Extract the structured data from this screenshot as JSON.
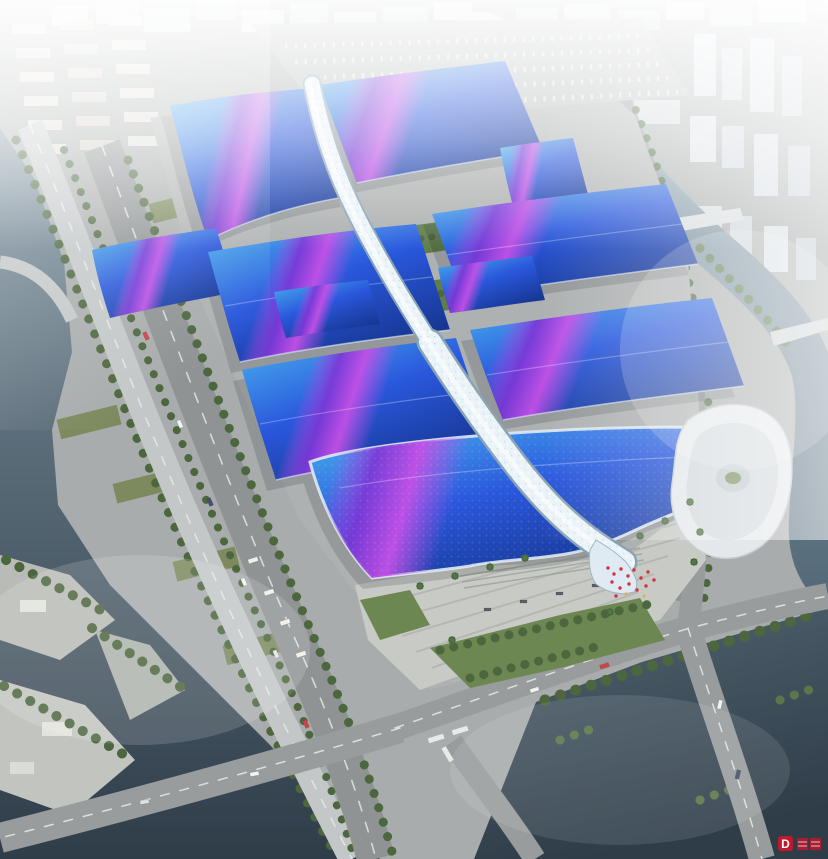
{
  "scene": {
    "type": "aerial-architectural-rendering",
    "subject": "riverside-exhibition-convention-center-complex",
    "watermark": {
      "logo_letter": "D",
      "adjacent_glyphs_illegible": true
    },
    "colors": {
      "roof_cyan": "#49b4ee",
      "roof_blue": "#2a58dd",
      "roof_deep_blue": "#16358f",
      "stripe_magenta": "#c44fe6",
      "stripe_violet": "#7d36d6",
      "spine_white": "#eaf3f8",
      "spine_shade": "#8ba4b5",
      "water_light": "#7b909d",
      "water_dark": "#2f3d49",
      "ground": "#a9acac",
      "road": "#8f9394",
      "plaza": "#c8cac5",
      "lawn_green": "#6d8752",
      "tree_green": "#4c663e",
      "watermark_red": "#c0182c"
    }
  }
}
